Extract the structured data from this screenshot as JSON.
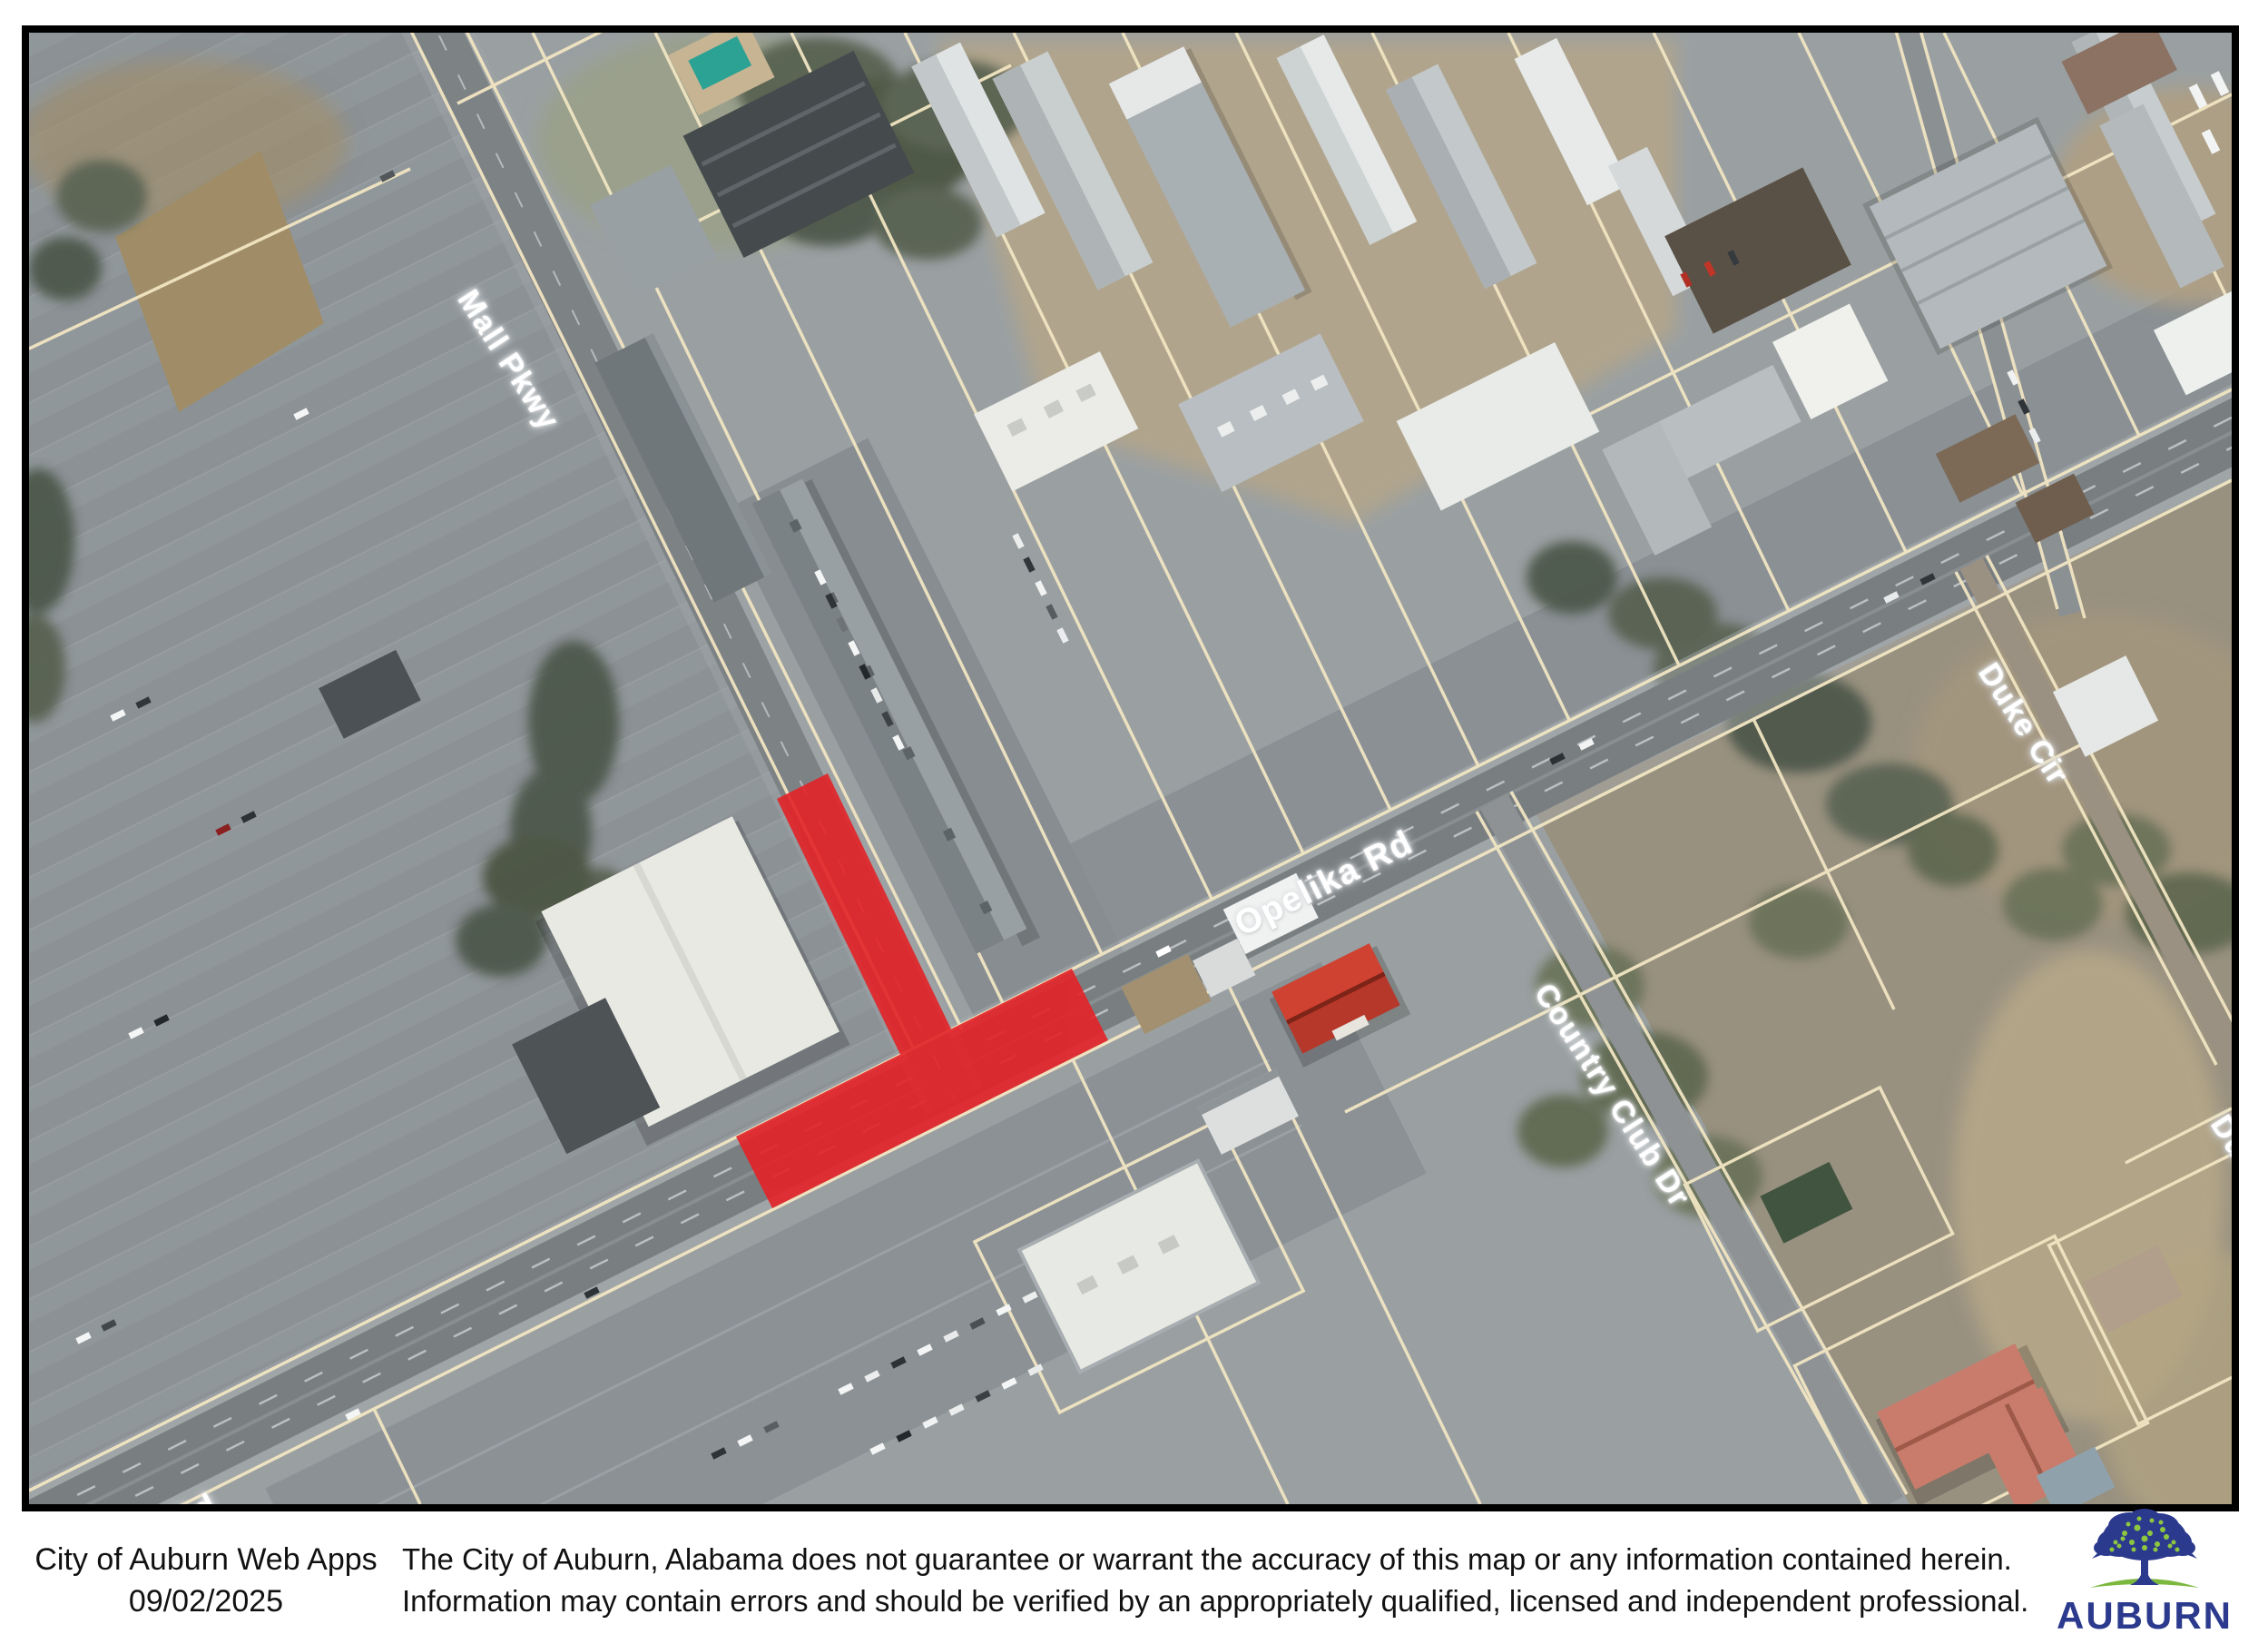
{
  "map": {
    "labels": {
      "mall_pkwy": "Mall Pkwy",
      "opelika_rd": "Opelika Rd",
      "opelika_rd_partial": "Opelika Rd",
      "duke_cir": "Duke Cir",
      "duke_cir_partial": "Duke Cir",
      "country_club_dr": "Country Club Dr"
    },
    "highlight_color": "#e32227",
    "parcel_line_color": "#f1e5c2",
    "label_text_color": "#ffffff"
  },
  "footer": {
    "app_name": "City of Auburn Web Apps",
    "date": "09/02/2025",
    "disclaimer_line1": "The City of Auburn, Alabama does not guarantee or warrant the accuracy of this map or any information contained herein.",
    "disclaimer_line2": "Information may contain errors and should be verified by an appropriately qualified, licensed and independent professional.",
    "logo_text": "AUBURN",
    "logo_navy": "#2c3a8e",
    "logo_green": "#8dc63f",
    "logo_ground_green": "#7cb83e"
  }
}
